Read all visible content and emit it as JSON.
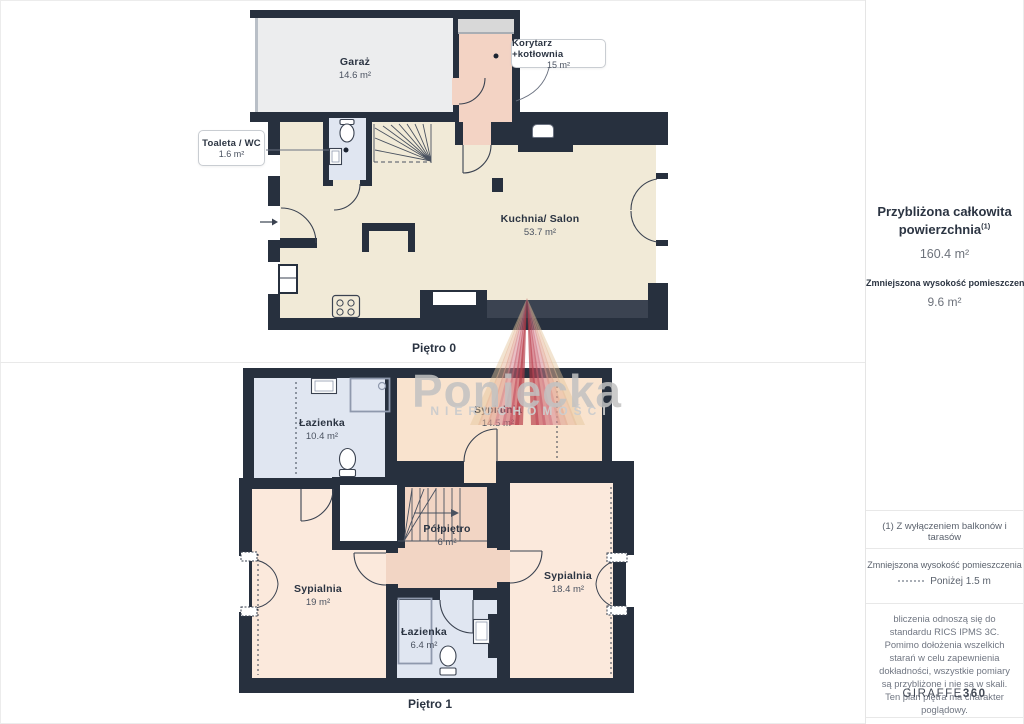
{
  "watermark": {
    "brand": "Poniecka",
    "subtitle": "NIERUCHOMOŚCI"
  },
  "floors": [
    {
      "name": "Piętro 0",
      "rooms": [
        {
          "name": "Garaż",
          "area": "14.6 m²"
        },
        {
          "name": "Korytarz +kotłownia",
          "area": "15 m²"
        },
        {
          "name": "Toaleta / WC",
          "area": "1.6 m²"
        },
        {
          "name": "Kuchnia/ Salon",
          "area": "53.7 m²"
        }
      ]
    },
    {
      "name": "Piętro 1",
      "rooms": [
        {
          "name": "Łazienka",
          "area": "10.4 m²"
        },
        {
          "name": "Sypialnia",
          "area": "14.5 m²"
        },
        {
          "name": "Półpiętro",
          "area": "6 m²"
        },
        {
          "name": "Sypialnia",
          "area": "19 m²"
        },
        {
          "name": "Sypialnia",
          "area": "18.4 m²"
        },
        {
          "name": "Łazienka",
          "area": "6.4 m²"
        }
      ]
    }
  ],
  "sidebar": {
    "total_title": "Przybliżona całkowita powierzchnia",
    "total_footnote": "(1)",
    "total_value": "160.4 m²",
    "reduced_title": "Zmniejszona wysokość pomieszczenia",
    "reduced_value": "9.6 m²",
    "footnote": "(1) Z wyłączeniem balkonów i tarasów",
    "legend_title": "Zmniejszona wysokość pomieszczenia",
    "legend_value": "Poniżej 1.5 m",
    "disclaimer": "bliczenia odnoszą się do standardu RICS IPMS 3C. Pomimo dołożenia wszelkich starań w celu zapewnienia dokładności, wszystkie pomiary są przybliżone i nie są w skali. Ten plan piętra ma charakter poglądowy.",
    "logo": "GIRAFFE",
    "logo_bold": "360"
  },
  "colors": {
    "wall": "#27303e",
    "garage_floor": "#ecedee",
    "hallway_floor": "#f3d3c4",
    "bathroom_floor": "#e0e6f1",
    "kitchen_floor": "#f1ead7",
    "bedroom_floor": "#f9e3ce",
    "bedroom_light_floor": "#fbe9dc",
    "half_floor": "#f2d5c4",
    "watermark_red": "#c24a5a"
  }
}
